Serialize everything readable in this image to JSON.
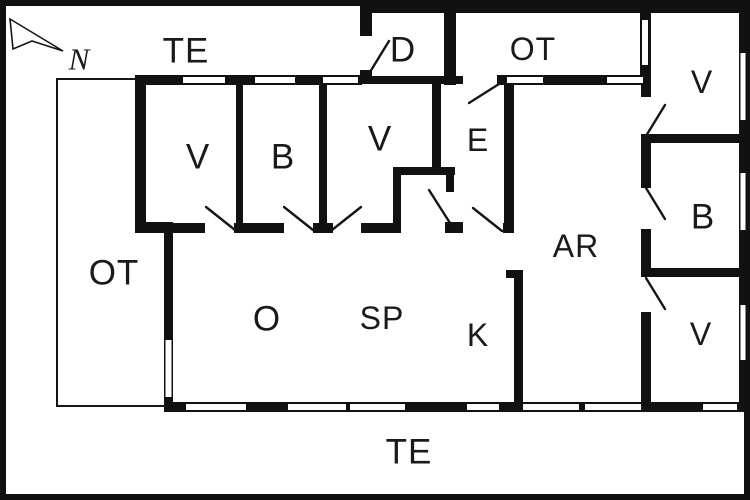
{
  "title": "House floor plan",
  "colors": {
    "wall": "#111111",
    "background": "#ffffff",
    "text": "#1a1a1a"
  },
  "compass": {
    "north_label": "N",
    "icon": "north-arrow-icon"
  },
  "labels": {
    "te_top": "TE",
    "d": "D",
    "ot_top": "OT",
    "v_top_right": "V",
    "v1": "V",
    "b1": "B",
    "v3": "V",
    "e": "E",
    "ot_left": "OT",
    "ar": "AR",
    "b_right": "B",
    "o": "O",
    "sp": "SP",
    "k": "K",
    "v_bottom_right": "V",
    "te_bottom": "TE"
  },
  "legend_note_icons": {
    "window_symbol": "thin white slot inside thick wall",
    "door_symbol": "diagonal swing line at wall opening"
  }
}
